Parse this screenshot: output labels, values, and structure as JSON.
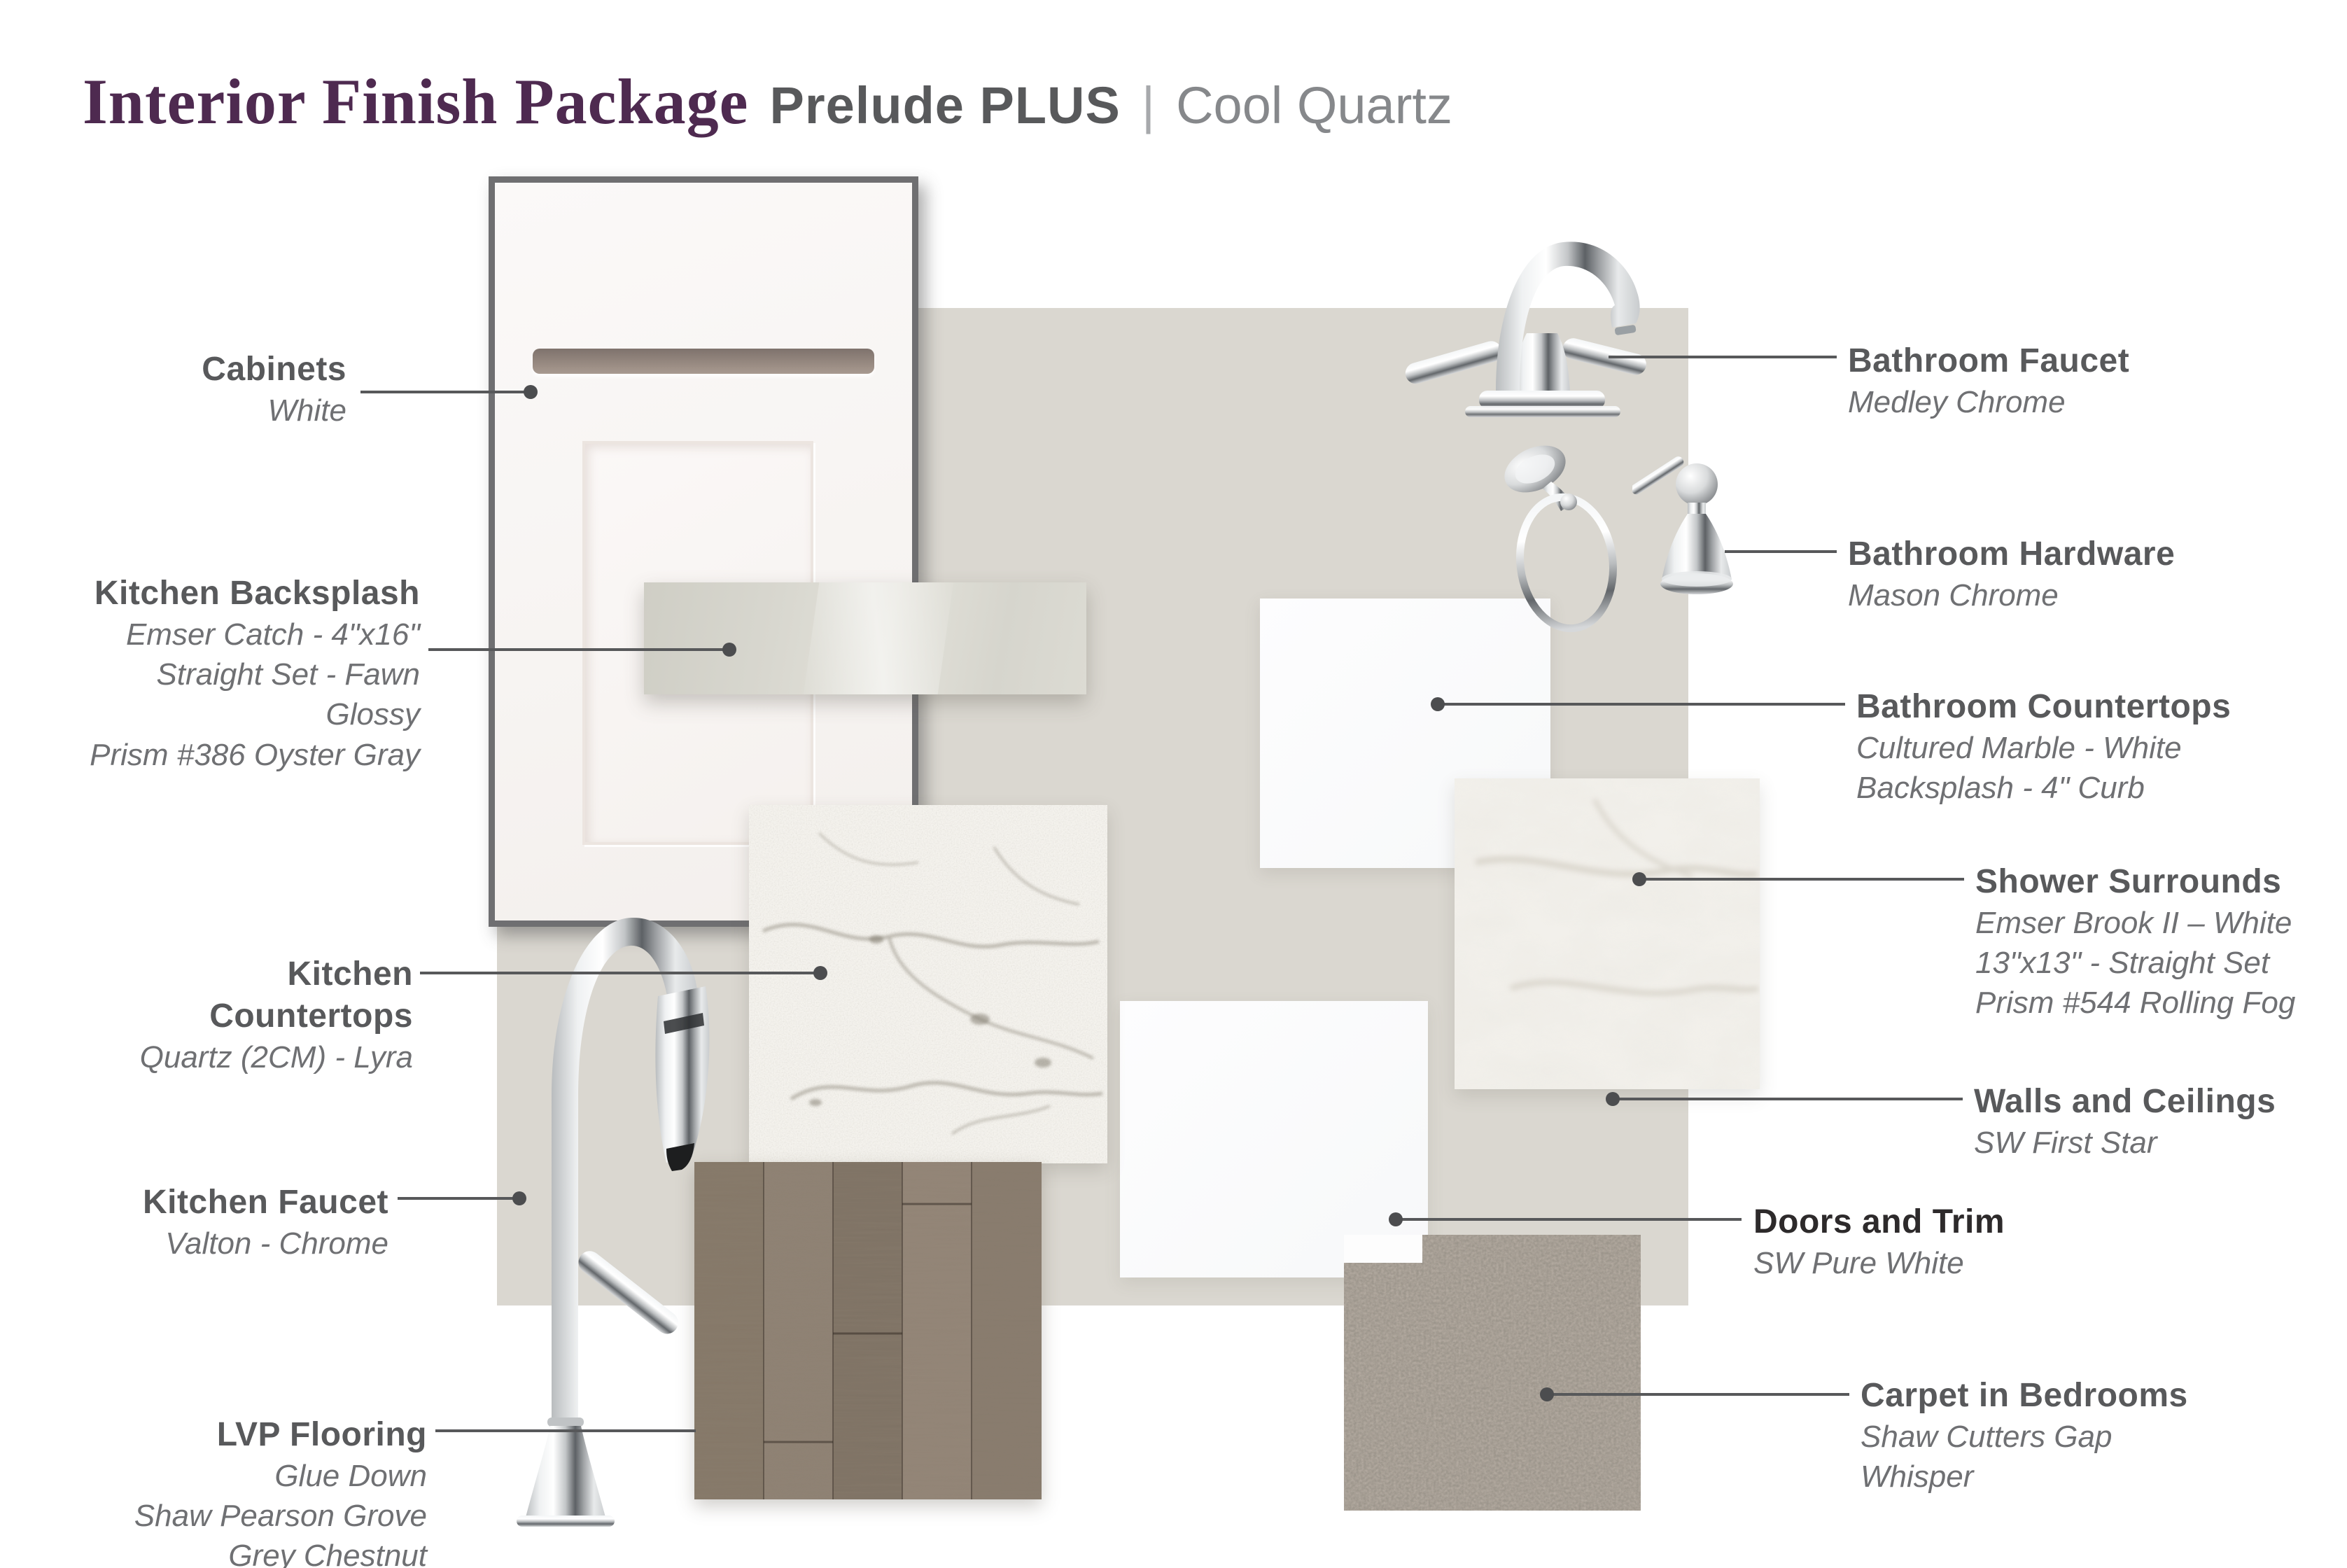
{
  "header": {
    "title": "Interior Finish Package",
    "package_name": "Prelude PLUS",
    "separator": "|",
    "palette_name": "Cool Quartz"
  },
  "items": [
    {
      "id": "cabinets",
      "label": "Cabinets",
      "details": [
        "White"
      ]
    },
    {
      "id": "kitchen-backsplash",
      "label": "Kitchen Backsplash",
      "details": [
        "Emser Catch - 4\"x16\"",
        "Straight Set - Fawn Glossy",
        "Prism #386 Oyster Gray"
      ]
    },
    {
      "id": "kitchen-countertops",
      "label": "Kitchen Countertops",
      "details": [
        "Quartz (2CM)  - Lyra"
      ]
    },
    {
      "id": "kitchen-faucet",
      "label": "Kitchen Faucet",
      "details": [
        "Valton - Chrome"
      ]
    },
    {
      "id": "lvp-flooring",
      "label": "LVP Flooring",
      "details": [
        "Glue Down",
        "Shaw Pearson Grove",
        "Grey Chestnut"
      ]
    },
    {
      "id": "bathroom-faucet",
      "label": "Bathroom Faucet",
      "details": [
        "Medley Chrome"
      ]
    },
    {
      "id": "bathroom-hardware",
      "label": "Bathroom Hardware",
      "details": [
        "Mason Chrome"
      ]
    },
    {
      "id": "bathroom-countertops",
      "label": "Bathroom Countertops",
      "details": [
        "Cultured Marble - White",
        "Backsplash - 4\" Curb"
      ]
    },
    {
      "id": "shower-surrounds",
      "label": "Shower Surrounds",
      "details": [
        "Emser Brook II – White",
        "13\"x13\" - Straight Set",
        "Prism #544 Rolling Fog"
      ]
    },
    {
      "id": "walls-ceilings",
      "label": "Walls and Ceilings",
      "details": [
        "SW First Star"
      ]
    },
    {
      "id": "doors-trim",
      "label": "Doors and Trim",
      "details": [
        "SW Pure White"
      ]
    },
    {
      "id": "carpet-bedrooms",
      "label": "Carpet in Bedrooms",
      "details": [
        "Shaw Cutters Gap",
        "Whisper"
      ]
    }
  ],
  "palette": {
    "title-purple": "#4e2a50",
    "heading-gray": "#58595b",
    "subtext-gray": "#6f7073",
    "doors-heading": "#2d2a2b",
    "leader-gray": "#57585a",
    "wall-beige": "#dad7d0",
    "page-bg": "#ffffff"
  }
}
